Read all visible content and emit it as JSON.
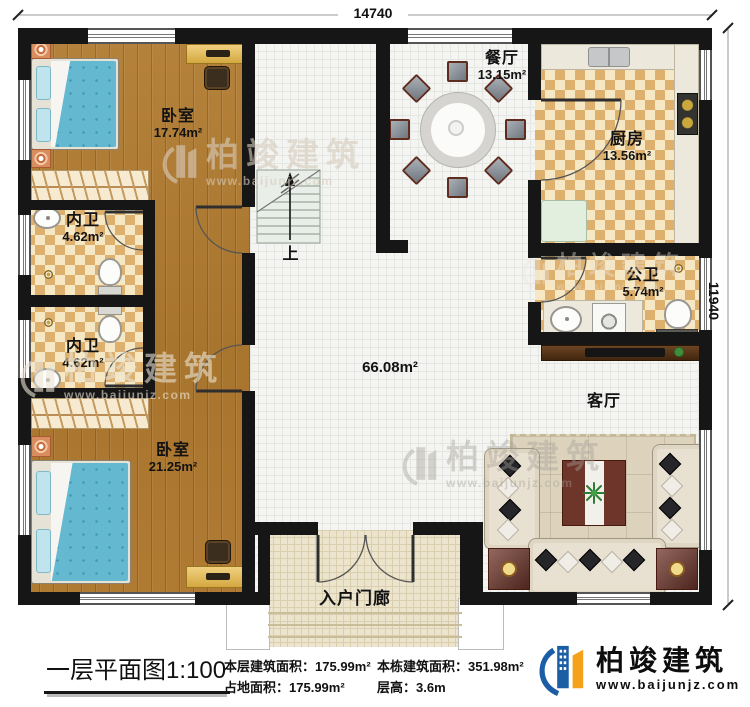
{
  "title": {
    "text": "一层平面图",
    "scale": "1:100"
  },
  "dimensions": {
    "top": "14740",
    "right": "11940"
  },
  "rooms": [
    {
      "id": "bedroom-1",
      "label": "卧室",
      "area": "17.74m²"
    },
    {
      "id": "bathroom-1",
      "label": "内卫",
      "area": "4.62m²"
    },
    {
      "id": "bathroom-2",
      "label": "内卫",
      "area": "4.62m²"
    },
    {
      "id": "bedroom-2",
      "label": "卧室",
      "area": "21.25m²"
    },
    {
      "id": "dining",
      "label": "餐厅",
      "area": "13.15m²"
    },
    {
      "id": "kitchen",
      "label": "厨房",
      "area": "13.56m²"
    },
    {
      "id": "public-bath",
      "label": "公卫",
      "area": "5.74m²"
    },
    {
      "id": "living",
      "label": "客厅",
      "area": ""
    },
    {
      "id": "hall",
      "label": "",
      "area": "66.08m²"
    },
    {
      "id": "porch",
      "label": "入户门廊",
      "area": ""
    }
  ],
  "stairs": {
    "label": "上"
  },
  "info": [
    {
      "label": "本层建筑面积：",
      "value": "175.99m²"
    },
    {
      "label": "占地面积：",
      "value": "175.99m²"
    },
    {
      "label": "本栋建筑面积：",
      "value": "351.98m²"
    },
    {
      "label": "层高：",
      "value": "3.6m"
    }
  ],
  "logo": {
    "name": "柏竣建筑",
    "url": "www.baijunjz.com"
  },
  "watermark": {
    "name": "柏竣建筑",
    "url": "www.baijunjz.com"
  },
  "colors": {
    "wall": "#161616",
    "wood_floor": "#ab7a33",
    "checker_tile": "#ddb06e",
    "bed_blue": "#64b9d1",
    "logo_blue": "#1b5ea6",
    "logo_orange": "#f5a21b"
  }
}
